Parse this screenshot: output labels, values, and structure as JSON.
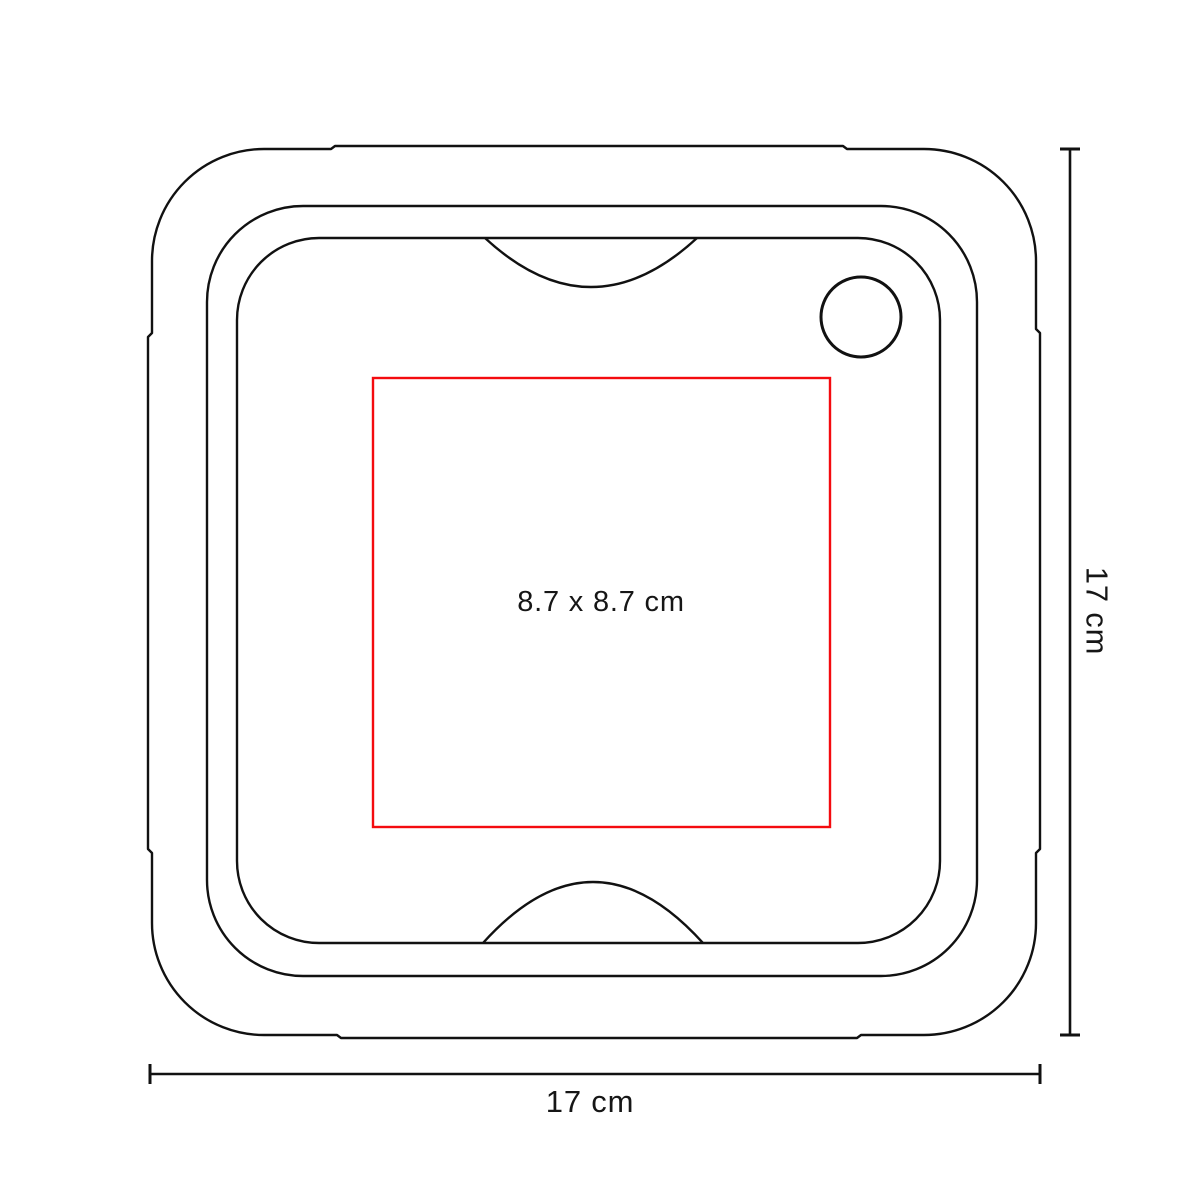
{
  "diagram": {
    "imprint_area": {
      "label": "8.7 x 8.7 cm",
      "stroke_color": "#f40b0f"
    },
    "width_dimension": {
      "label": "17 cm"
    },
    "height_dimension": {
      "label": "17 cm"
    },
    "outline_color": "#111111",
    "background_color": "#ffffff",
    "text_color": "#161616"
  }
}
